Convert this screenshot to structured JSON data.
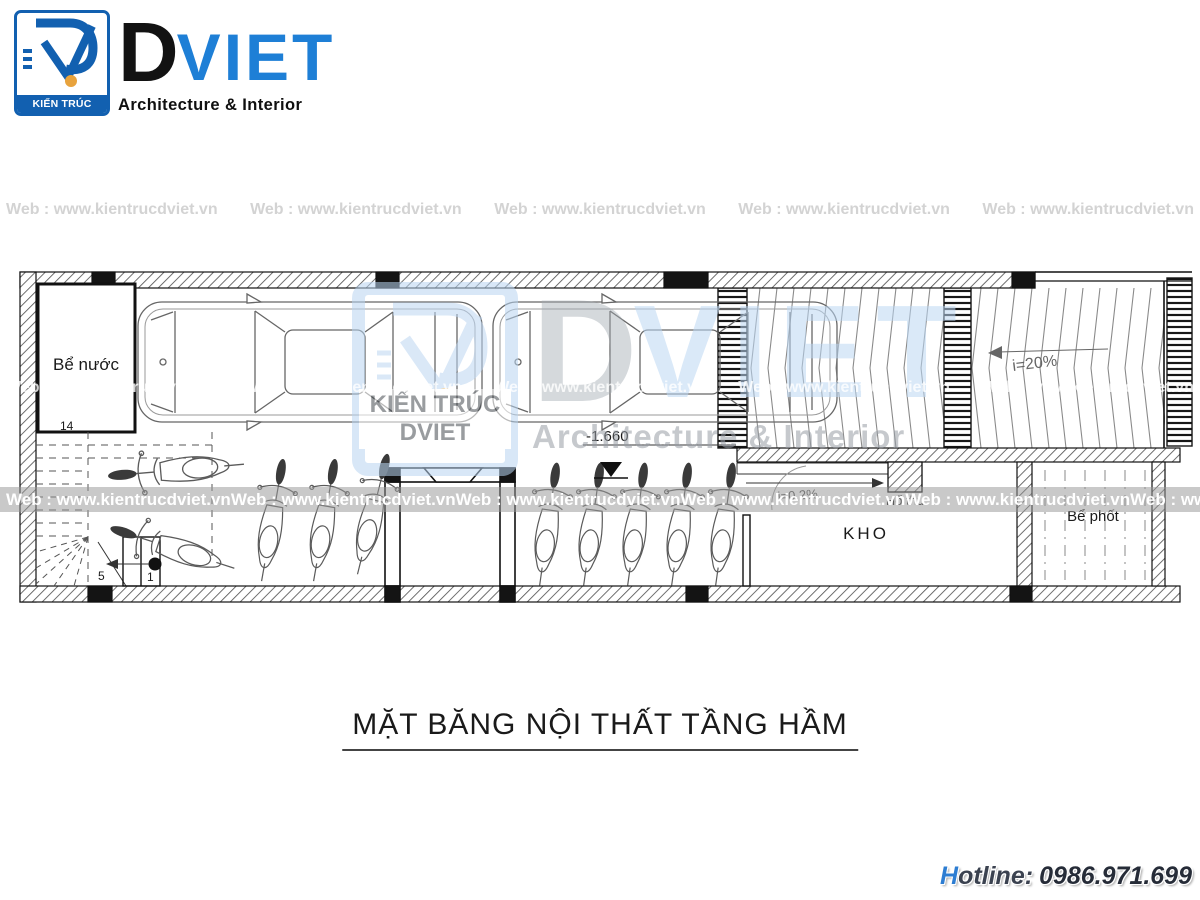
{
  "header_logo": {
    "box_title": "KIẾN TRÚC DVIET",
    "brand_d": "D",
    "brand_viet": "VIET",
    "tagline": "Architecture & Interior"
  },
  "watermark": {
    "band_text": "Web : www.kientrucdviet.vn",
    "center_box_title": "KIẾN TRÚC DVIET",
    "center_brand_d": "D",
    "center_brand_viet": "VIET",
    "center_tagline": "Architecture & Interior"
  },
  "plan_labels": {
    "water_tank": "Bể nước",
    "dim_14": "14",
    "stair_5": "5",
    "stair_1": "1",
    "elevation": "-1.660",
    "ramp_slope": "i=20%",
    "drain_slope": "i=0.2%",
    "drain_pit": "Hố thu",
    "storage": "KHO",
    "septic": "Bể phốt"
  },
  "title": "MẶT BĂNG NỘI THẤT TẦNG HẦM",
  "hotline": {
    "label_h": "H",
    "label_rest": "otline:",
    "number": "0986.971.699"
  },
  "colors": {
    "brand_blue": "#1260b0",
    "accent_orange": "#e8a33d",
    "hotline_blue": "#2d7dd2"
  }
}
